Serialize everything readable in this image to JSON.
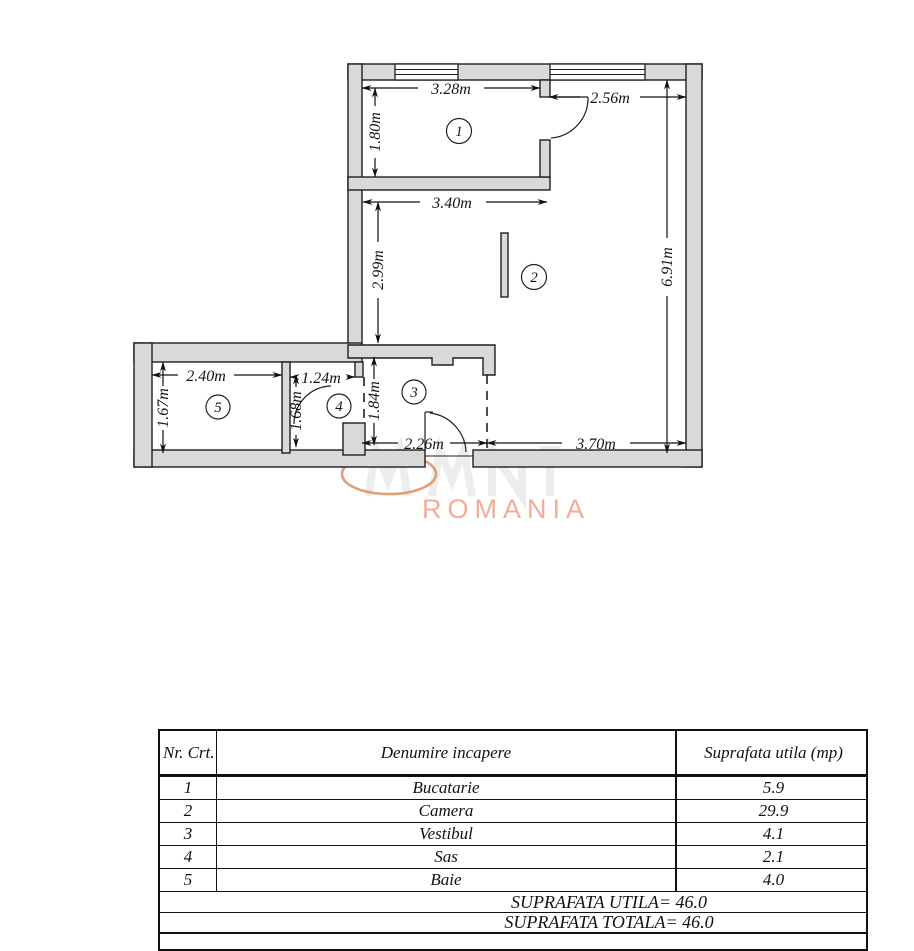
{
  "floor_plan": {
    "room_labels": {
      "r1": "1",
      "r2": "2",
      "r3": "3",
      "r4": "4",
      "r5": "5"
    },
    "dimensions": {
      "kitchen_width": "3.28m",
      "entry_top_width": "2.56m",
      "kitchen_depth": "1.80m",
      "living_width": "3.40m",
      "living_depth": "2.99m",
      "right_side_depth": "6.91m",
      "bath_width": "2.40m",
      "sas_width": "1.24m",
      "bath_depth": "1.67m",
      "sas_depth": "1.68m",
      "vestibule_depth": "1.84m",
      "vestibule_width": "2.26m",
      "bottom_right_width": "3.70m"
    },
    "colors": {
      "wall_fill": "#d9d9d9",
      "line": "#1f1f1f"
    }
  },
  "watermark": {
    "text": "ROMANIA",
    "text_color": "#f4ab97",
    "ellipse_color": "#dd8e60"
  },
  "table": {
    "headers": {
      "nr": "Nr. Crt.",
      "name": "Denumire incapere",
      "area": "Suprafata utila (mp)"
    },
    "rows": [
      {
        "nr": "1",
        "name": "Bucatarie",
        "area": "5.9"
      },
      {
        "nr": "2",
        "name": "Camera",
        "area": "29.9"
      },
      {
        "nr": "3",
        "name": "Vestibul",
        "area": "4.1"
      },
      {
        "nr": "4",
        "name": "Sas",
        "area": "2.1"
      },
      {
        "nr": "5",
        "name": "Baie",
        "area": "4.0"
      }
    ],
    "totals": {
      "utila": "SUPRAFATA UTILA=  46.0",
      "totala": "SUPRAFATA TOTALA= 46.0"
    }
  }
}
